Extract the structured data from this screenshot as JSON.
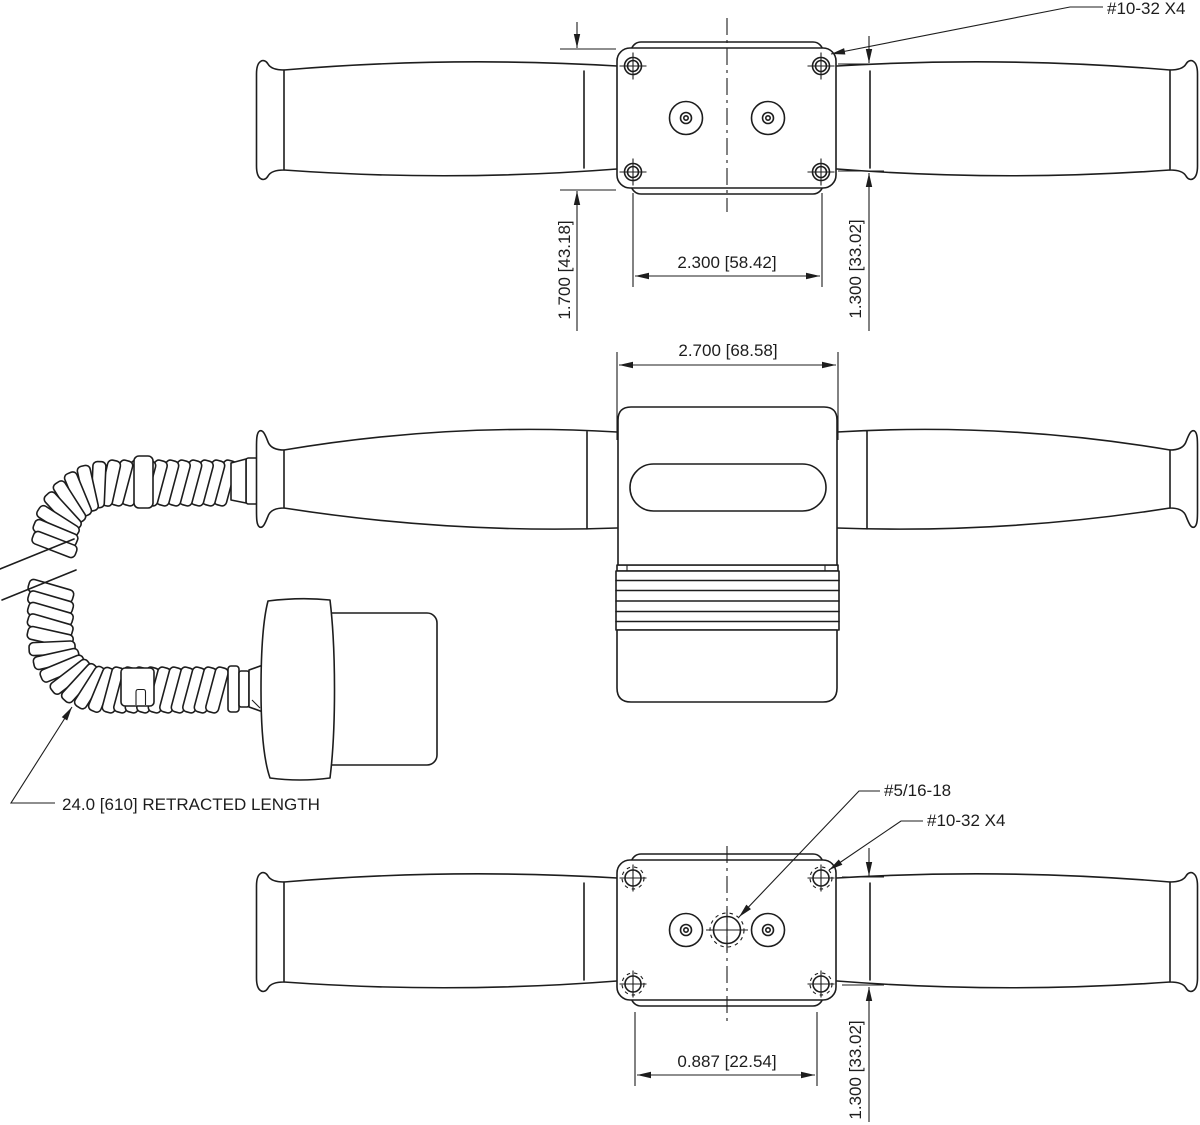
{
  "drawing": {
    "background": "#ffffff",
    "line_color": "#1d1d1d",
    "top_view": {
      "screw_callout": "#10-32 X4",
      "dim_box_height": "1.700 [43.18]",
      "dim_box_width": "2.300 [58.42]",
      "dim_hole_spacing": "1.300 [33.02]"
    },
    "front_view": {
      "dim_body_width": "2.700 [68.58]",
      "cable_note": "24.0 [610] RETRACTED LENGTH"
    },
    "bottom_view": {
      "center_thread_callout": "#5/16-18",
      "screw_callout": "#10-32 X4",
      "dim_hole_width": "0.887 [22.54]",
      "dim_hole_spacing": "1.300 [33.02]"
    }
  }
}
